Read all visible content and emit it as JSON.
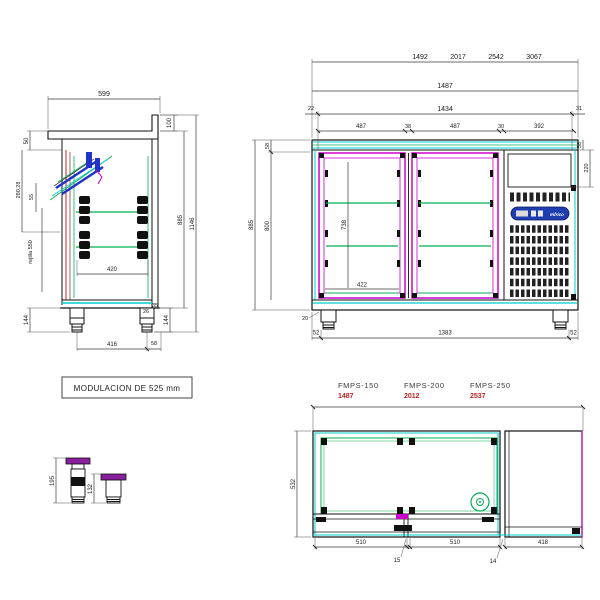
{
  "side_view": {
    "width_top": "599",
    "splash_height": "100",
    "total_height": "1146",
    "body_height": "885",
    "top_thickness": "50",
    "diag_depth": "280,28",
    "slide_gap": "55",
    "rejilla": "rejilla 550",
    "inner_width": "420",
    "foot_height_left": "144",
    "feet_span": "416",
    "foot_width": "58",
    "foot_height_right": "144",
    "foot_d1": "26",
    "foot_d2": "35"
  },
  "front_view": {
    "variant_widths": [
      "1492",
      "2017",
      "2542",
      "3067"
    ],
    "total_width": "1487",
    "inner_width": "1434",
    "left_edge": "22",
    "right_edge": "31",
    "door1_width": "487",
    "gap1": "38",
    "door2_width": "487",
    "gap2": "30",
    "motor_width": "392",
    "body_height": "885",
    "top_height": "58",
    "inner_height": "800",
    "door_height": "738",
    "door_inner_width": "422",
    "panel_height": "220",
    "motor_top": "58",
    "plinth": "20",
    "foot_offset_left": "52",
    "feet_span": "1383",
    "foot_offset_right": "52",
    "brand": "Infrico"
  },
  "notes": {
    "modulation": "MODULACION DE 525 mm"
  },
  "foot_details": {
    "tall_height": "195",
    "short_height": "132"
  },
  "plan_view": {
    "models": [
      {
        "name": "FMPS-150",
        "width": "1487"
      },
      {
        "name": "FMPS-200",
        "width": "2012"
      },
      {
        "name": "FMPS-250",
        "width": "2537"
      }
    ],
    "depth": "532",
    "door1": "510",
    "gap1": "15",
    "door2": "510",
    "gap2": "14",
    "motor": "418"
  },
  "colors": {
    "accent_red": "#c32222",
    "magenta": "#cc00cc",
    "green": "#00b050",
    "cyan": "#00cccc",
    "blue": "#2233cc",
    "panel_blue": "#1d3db0",
    "foot_purple": "#8a1f9e"
  }
}
